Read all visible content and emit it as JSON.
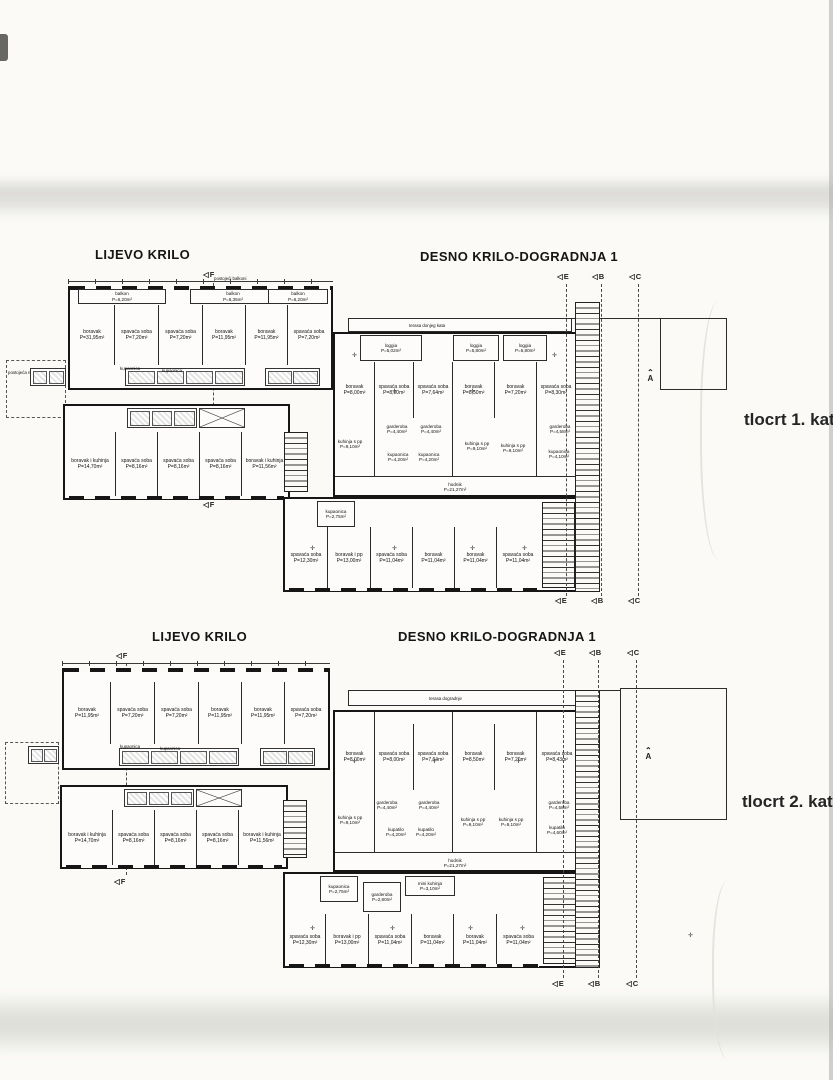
{
  "icons": {
    "section_tag": "◁",
    "level_mark": "✛",
    "north_caret": "⌃"
  },
  "plan1": {
    "left_wing_title": "LIJEVO KRILO",
    "right_wing_title": "DESNO KRILO-DOGRADNJA 1",
    "caption": "tlocrt  1. kata",
    "markers": {
      "f": "F",
      "e": "E",
      "b": "B",
      "c": "C",
      "a": "A"
    },
    "left_wing": {
      "balconies_note": "postojeći balkoni",
      "canopy_label": "postojeća nadstrešnica",
      "balconies": [
        {
          "name": "balkon",
          "area": "P=6,20m²"
        },
        {
          "name": "balkon",
          "area": "P=6,35m²"
        },
        {
          "name": "balkon",
          "area": "P=6,20m²"
        }
      ],
      "rooms_top": [
        {
          "name": "boravak",
          "area": "P=31,95m²"
        },
        {
          "name": "spavaća soba",
          "area": "P=7,20m²"
        },
        {
          "name": "spavaća soba",
          "area": "P=7,20m²"
        },
        {
          "name": "boravak",
          "area": "P=11,95m²"
        },
        {
          "name": "boravak",
          "area": "P=11,95m²"
        },
        {
          "name": "spavaća soba",
          "area": "P=7,20m²"
        }
      ],
      "bath_labels": [
        "kupaonica",
        "kupaonica"
      ],
      "rooms_bottom": [
        {
          "name": "boravak i kuhinja",
          "area": "P=14,70m²"
        },
        {
          "name": "spavaća soba",
          "area": "P=8,16m²"
        },
        {
          "name": "spavaća soba",
          "area": "P=8,16m²"
        },
        {
          "name": "spavaća soba",
          "area": "P=8,16m²"
        },
        {
          "name": "boravak i kuhinja",
          "area": "P=11,56m²"
        }
      ]
    },
    "right_wing": {
      "terrace_label": "terasa donjeg kata",
      "loggias": [
        {
          "name": "loggia",
          "area": "P=5,02m²"
        },
        {
          "name": "loggia",
          "area": "P=5,80m²"
        },
        {
          "name": "loggia",
          "area": "P=5,80m²"
        }
      ],
      "rooms_top": [
        {
          "name": "boravak",
          "area": "P=8,00m²"
        },
        {
          "name": "spavaća soba",
          "area": "P=8,00m²"
        },
        {
          "name": "spavaća soba",
          "area": "P=7,64m²"
        },
        {
          "name": "boravak",
          "area": "P=8,50m²"
        },
        {
          "name": "boravak",
          "area": "P=7,20m²"
        },
        {
          "name": "spavaća soba",
          "area": "P=8,30m²"
        }
      ],
      "rooms_mid": [
        {
          "name": "kuhinja s pp",
          "area": "P=9,10m²"
        },
        {
          "name": "garderoba",
          "area": "P=4,40m²"
        },
        {
          "name": "garderoba",
          "area": "P=4,40m²"
        },
        {
          "name": "kupaonica",
          "area": "P=4,20m²"
        },
        {
          "name": "kupaonica",
          "area": "P=4,20m²"
        },
        {
          "name": "kuhinja s pp",
          "area": "P=9,10m²"
        },
        {
          "name": "kuhinja s pp",
          "area": "P=9,10m²"
        },
        {
          "name": "garderoba",
          "area": "P=4,58m²"
        },
        {
          "name": "kupaonica",
          "area": "P=4,10m²"
        }
      ],
      "corridor": {
        "name": "hodnik",
        "area": "P=21,27m²"
      },
      "small_bath": {
        "name": "kupaonica",
        "area": "P=2,75m²"
      },
      "rooms_bottom": [
        {
          "name": "spavaća soba",
          "area": "P=12,30m²"
        },
        {
          "name": "boravak i pp",
          "area": "P=13,00m²"
        },
        {
          "name": "spavaća soba",
          "area": "P=11,04m²"
        },
        {
          "name": "boravak",
          "area": "P=11,04m²"
        },
        {
          "name": "boravak",
          "area": "P=11,04m²"
        },
        {
          "name": "spavaća soba",
          "area": "P=11,04m²"
        }
      ]
    }
  },
  "plan2": {
    "left_wing_title": "LIJEVO KRILO",
    "right_wing_title": "DESNO KRILO-DOGRADNJA 1",
    "caption": "tlocrt 2. kata",
    "markers": {
      "f": "F",
      "e": "E",
      "b": "B",
      "c": "C",
      "a": "A"
    },
    "left_wing": {
      "rooms_top": [
        {
          "name": "boravak",
          "area": "P=11,95m²"
        },
        {
          "name": "spavaća soba",
          "area": "P=7,20m²"
        },
        {
          "name": "spavaća soba",
          "area": "P=7,20m²"
        },
        {
          "name": "boravak",
          "area": "P=11,95m²"
        },
        {
          "name": "boravak",
          "area": "P=11,95m²"
        },
        {
          "name": "spavaća soba",
          "area": "P=7,20m²"
        }
      ],
      "bath_labels": [
        "kupaonica",
        "kupaonica"
      ],
      "rooms_bottom": [
        {
          "name": "boravak i kuhinja",
          "area": "P=14,70m²"
        },
        {
          "name": "spavaća soba",
          "area": "P=8,16m²"
        },
        {
          "name": "spavaća soba",
          "area": "P=8,16m²"
        },
        {
          "name": "spavaća soba",
          "area": "P=8,16m²"
        },
        {
          "name": "boravak i kuhinja",
          "area": "P=11,56m²"
        }
      ]
    },
    "right_wing": {
      "terrace_label": "terasa dogradnje",
      "rooms_top": [
        {
          "name": "boravak",
          "area": "P=8,00m²"
        },
        {
          "name": "spavaća soba",
          "area": "P=8,00m²"
        },
        {
          "name": "spavaća soba",
          "area": "P=7,64m²"
        },
        {
          "name": "boravak",
          "area": "P=8,50m²"
        },
        {
          "name": "boravak",
          "area": "P=7,20m²"
        },
        {
          "name": "spavaća soba",
          "area": "P=8,43m²"
        }
      ],
      "rooms_mid": [
        {
          "name": "kuhinja s pp",
          "area": "P=9,10m²"
        },
        {
          "name": "garderoba",
          "area": "P=4,40m²"
        },
        {
          "name": "garderoba",
          "area": "P=4,40m²"
        },
        {
          "name": "kupatilo",
          "area": "P=4,20m²"
        },
        {
          "name": "kupatilo",
          "area": "P=4,20m²"
        },
        {
          "name": "kuhinja s pp",
          "area": "P=9,10m²"
        },
        {
          "name": "kuhinja s pp",
          "area": "P=9,10m²"
        },
        {
          "name": "garderoba",
          "area": "P=4,58m²"
        },
        {
          "name": "kupatilo",
          "area": "P=4,60m²"
        }
      ],
      "corridor": {
        "name": "hodnik",
        "area": "P=21,27m²"
      },
      "small_bath": {
        "name": "kupaonica",
        "area": "P=2,75m²"
      },
      "wardrobe": {
        "name": "garderoba",
        "area": "P=2,80m²"
      },
      "mini_kitchen": {
        "name": "mini kuhinja",
        "area": "P=3,10m²"
      },
      "rooms_bottom": [
        {
          "name": "spavaća soba",
          "area": "P=12,30m²"
        },
        {
          "name": "boravak i pp",
          "area": "P=13,00m²"
        },
        {
          "name": "spavaća soba",
          "area": "P=11,04m²"
        },
        {
          "name": "boravak",
          "area": "P=11,04m²"
        },
        {
          "name": "boravak",
          "area": "P=11,04m²"
        },
        {
          "name": "spavaća soba",
          "area": "P=11,04m²"
        }
      ]
    }
  }
}
